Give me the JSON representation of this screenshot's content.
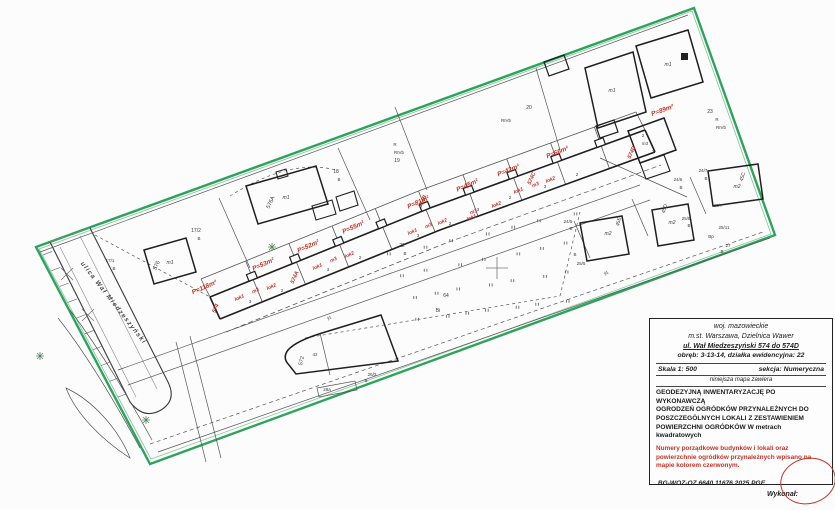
{
  "colors": {
    "boundary_green": "#2ea35b",
    "annotation_red": "#c23326",
    "line_black": "#3a3a3a"
  },
  "title_block": {
    "region1": "woj. mazowieckie",
    "region2": "m.st. Warszawa, Dzielnica Wawer",
    "address": "ul. Wał Miedzeszyński 574 do 574D",
    "plot": "obręb: 3-13-14, działka ewidencyjna: 22",
    "scale_label": "Skala 1: 500",
    "section_label": "sekcja: Numeryczna",
    "contains_note": "niniejsza mapa zawiera",
    "subject_lines": [
      "GEODEZYJNĄ  INWENTARYZACJĘ PO WYKONAWCZĄ",
      "OGRODZEŃ OGRÓDKÓW PRZYNALEŻNYCH DO",
      "POSZCZEGÓLNYCH LOKALI Z ZESTAWIENIEM",
      "POWIERZCHNI  OGRÓDKÓW W metrach kwadratowych"
    ],
    "red_note_lines": [
      "Numery porządkowe budynków i lokali oraz",
      "powierzchnie ogródków przynależnych wpisano  na",
      "mapie kolorem czerwonym."
    ],
    "doc_number": ".BG-WOZ-OZ.6640.11676.2025.PGE",
    "author_label": "Wykonał:"
  },
  "map": {
    "labels": [
      {
        "t": "ulica Wał Miedzeszyński",
        "x": 112,
        "y": 304,
        "r": 52,
        "s": 6.5,
        "c": "street",
        "n": "street-name-label"
      },
      {
        "t": "P=118m²",
        "x": 205,
        "y": 289,
        "r": -24,
        "s": 6.5,
        "c": "red",
        "n": "garden-area-label"
      },
      {
        "t": "P=53m²",
        "x": 264,
        "y": 266,
        "r": -24,
        "s": 6.5,
        "c": "red",
        "n": "garden-area-label"
      },
      {
        "t": "P=52m²",
        "x": 309,
        "y": 248,
        "r": -24,
        "s": 6.5,
        "c": "red",
        "n": "garden-area-label"
      },
      {
        "t": "P=55m²",
        "x": 354,
        "y": 229,
        "r": -24,
        "s": 6.5,
        "c": "red",
        "n": "garden-area-label"
      },
      {
        "t": "P=81m²",
        "x": 419,
        "y": 204,
        "r": -24,
        "s": 6.5,
        "c": "red",
        "n": "garden-area-label"
      },
      {
        "t": "P=45m²",
        "x": 468,
        "y": 187,
        "r": -24,
        "s": 6.5,
        "c": "red",
        "n": "garden-area-label"
      },
      {
        "t": "P=42m²",
        "x": 509,
        "y": 172,
        "r": -22,
        "s": 6.5,
        "c": "red",
        "n": "garden-area-label"
      },
      {
        "t": "P=66m²",
        "x": 558,
        "y": 154,
        "r": -22,
        "s": 6.5,
        "c": "red",
        "n": "garden-area-label"
      },
      {
        "t": "P=89m²",
        "x": 663,
        "y": 112,
        "r": -20,
        "s": 6.5,
        "c": "red",
        "n": "garden-area-label"
      },
      {
        "t": "lok1",
        "x": 240,
        "y": 299,
        "r": -24,
        "s": 5,
        "c": "red",
        "n": "unit-label"
      },
      {
        "t": "lok2",
        "x": 272,
        "y": 288,
        "r": -24,
        "s": 5,
        "c": "red",
        "n": "unit-label"
      },
      {
        "t": "lok1",
        "x": 318,
        "y": 268,
        "r": -24,
        "s": 5,
        "c": "red",
        "n": "unit-label"
      },
      {
        "t": "lok2",
        "x": 350,
        "y": 256,
        "r": -24,
        "s": 5,
        "c": "red",
        "n": "unit-label"
      },
      {
        "t": "lok1",
        "x": 413,
        "y": 233,
        "r": -24,
        "s": 5,
        "c": "red",
        "n": "unit-label"
      },
      {
        "t": "lok2",
        "x": 443,
        "y": 223,
        "r": -24,
        "s": 5,
        "c": "red",
        "n": "unit-label"
      },
      {
        "t": "lok1",
        "x": 472,
        "y": 219,
        "r": -22,
        "s": 5,
        "c": "red",
        "n": "unit-label"
      },
      {
        "t": "lok2",
        "x": 497,
        "y": 206,
        "r": -22,
        "s": 5,
        "c": "red",
        "n": "unit-label"
      },
      {
        "t": "lok1",
        "x": 519,
        "y": 192,
        "r": -22,
        "s": 5,
        "c": "red",
        "n": "unit-label"
      },
      {
        "t": "lok2",
        "x": 551,
        "y": 181,
        "r": -22,
        "s": 5,
        "c": "red",
        "n": "unit-label"
      },
      {
        "t": "m3",
        "x": 256,
        "y": 292,
        "r": -24,
        "s": 5,
        "c": "red",
        "n": "unit-label"
      },
      {
        "t": "m3",
        "x": 334,
        "y": 261,
        "r": -24,
        "s": 5,
        "c": "red",
        "n": "unit-label"
      },
      {
        "t": "m3",
        "x": 429,
        "y": 227,
        "r": -24,
        "s": 5,
        "c": "red",
        "n": "unit-label"
      },
      {
        "t": "m3",
        "x": 474,
        "y": 213,
        "r": -22,
        "s": 5,
        "c": "red",
        "n": "unit-label"
      },
      {
        "t": "m3",
        "x": 536,
        "y": 186,
        "r": -22,
        "s": 5,
        "c": "red",
        "n": "unit-label"
      },
      {
        "t": "574",
        "x": 217,
        "y": 309,
        "r": -66,
        "s": 5.5,
        "c": "red",
        "n": "building-number-label"
      },
      {
        "t": "574A",
        "x": 296,
        "y": 278,
        "r": -66,
        "s": 5.5,
        "c": "red",
        "n": "building-number-label"
      },
      {
        "t": "574B",
        "x": 424,
        "y": 202,
        "r": -66,
        "s": 5.5,
        "c": "red",
        "n": "building-number-label"
      },
      {
        "t": "574C",
        "x": 533,
        "y": 179,
        "r": -66,
        "s": 5.5,
        "c": "red",
        "n": "building-number-label"
      },
      {
        "t": "574D",
        "x": 633,
        "y": 153,
        "r": -66,
        "s": 5.5,
        "c": "red",
        "n": "building-number-label"
      },
      {
        "t": "17/1",
        "x": 110,
        "y": 262,
        "s": 4.5,
        "c": "blk",
        "n": "parcel-label"
      },
      {
        "t": "B",
        "x": 114,
        "y": 270,
        "s": 4.5,
        "c": "blk",
        "n": "landuse-label"
      },
      {
        "t": "17/2",
        "x": 196,
        "y": 232,
        "s": 5,
        "c": "blk",
        "n": "parcel-label"
      },
      {
        "t": "B",
        "x": 199,
        "y": 240,
        "s": 4.5,
        "c": "blk",
        "n": "landuse-label"
      },
      {
        "t": "18",
        "x": 336,
        "y": 173,
        "s": 5,
        "c": "blk",
        "n": "parcel-label"
      },
      {
        "t": "B",
        "x": 339,
        "y": 181,
        "s": 4.5,
        "c": "blk",
        "n": "landuse-label"
      },
      {
        "t": "R",
        "x": 395,
        "y": 146,
        "s": 4.5,
        "c": "blk",
        "n": "landuse-label"
      },
      {
        "t": "RIVb",
        "x": 399,
        "y": 154,
        "s": 4.5,
        "c": "blk",
        "n": "landuse-label"
      },
      {
        "t": "19",
        "x": 397,
        "y": 162,
        "s": 5,
        "c": "blk",
        "n": "parcel-label"
      },
      {
        "t": "20",
        "x": 529,
        "y": 109,
        "s": 5,
        "c": "blk",
        "n": "parcel-label"
      },
      {
        "t": "RIVb",
        "x": 506,
        "y": 122,
        "s": 4.5,
        "c": "blk",
        "n": "landuse-label"
      },
      {
        "t": "23",
        "x": 710,
        "y": 113,
        "s": 5,
        "c": "blk",
        "n": "parcel-label"
      },
      {
        "t": "R",
        "x": 717,
        "y": 121,
        "s": 4.5,
        "c": "blk",
        "n": "landuse-label"
      },
      {
        "t": "RIVb",
        "x": 721,
        "y": 129,
        "s": 4.5,
        "c": "blk",
        "n": "landuse-label"
      },
      {
        "t": "22",
        "x": 402,
        "y": 247,
        "s": 5,
        "c": "blk",
        "n": "parcel-label"
      },
      {
        "t": "B",
        "x": 405,
        "y": 255,
        "s": 4.5,
        "c": "blk",
        "n": "landuse-label"
      },
      {
        "t": "64",
        "x": 446,
        "y": 297,
        "s": 5,
        "c": "blk",
        "n": "parcel-label"
      },
      {
        "t": "Bi",
        "x": 438,
        "y": 312,
        "s": 5,
        "c": "blk",
        "n": "landuse-label"
      },
      {
        "t": "24/5",
        "x": 568,
        "y": 223,
        "s": 4.5,
        "c": "blk",
        "n": "parcel-label"
      },
      {
        "t": "B",
        "x": 571,
        "y": 230,
        "s": 4.5,
        "c": "blk",
        "n": "landuse-label"
      },
      {
        "t": "B",
        "x": 575,
        "y": 256,
        "s": 4.5,
        "c": "blk",
        "n": "landuse-label"
      },
      {
        "t": "25/5",
        "x": 581,
        "y": 265,
        "s": 4.5,
        "c": "blk",
        "n": "parcel-label"
      },
      {
        "t": "24/6",
        "x": 678,
        "y": 181,
        "s": 4.5,
        "c": "blk",
        "n": "parcel-label"
      },
      {
        "t": "B",
        "x": 681,
        "y": 189,
        "s": 4.5,
        "c": "blk",
        "n": "landuse-label"
      },
      {
        "t": "24/7",
        "x": 703,
        "y": 172,
        "s": 4.5,
        "c": "blk",
        "n": "parcel-label"
      },
      {
        "t": "B",
        "x": 706,
        "y": 180,
        "s": 4.5,
        "c": "blk",
        "n": "landuse-label"
      },
      {
        "t": "25/9",
        "x": 686,
        "y": 220,
        "s": 4.5,
        "c": "blk",
        "n": "parcel-label"
      },
      {
        "t": "B",
        "x": 689,
        "y": 227,
        "s": 4.5,
        "c": "blk",
        "n": "landuse-label"
      },
      {
        "t": "25/7",
        "x": 718,
        "y": 207,
        "s": 4.5,
        "c": "blk",
        "n": "parcel-label"
      },
      {
        "t": "25/11",
        "x": 724,
        "y": 229,
        "s": 4.5,
        "c": "blk",
        "n": "parcel-label"
      },
      {
        "t": "Bp",
        "x": 711,
        "y": 238,
        "s": 4.5,
        "c": "blk",
        "n": "landuse-label"
      },
      {
        "t": "27",
        "x": 728,
        "y": 247,
        "s": 4.5,
        "c": "blk",
        "n": "parcel-label"
      },
      {
        "t": "B",
        "x": 722,
        "y": 253,
        "s": 4.5,
        "c": "blk",
        "n": "landuse-label"
      },
      {
        "t": "26/3",
        "x": 372,
        "y": 376,
        "s": 4.5,
        "c": "blk",
        "n": "parcel-label"
      },
      {
        "t": "B",
        "x": 366,
        "y": 382,
        "s": 4.5,
        "c": "blk",
        "n": "landuse-label"
      },
      {
        "t": "28a",
        "x": 327,
        "y": 391,
        "s": 4.5,
        "c": "blk",
        "n": "parcel-label"
      },
      {
        "t": "jd.",
        "x": 330,
        "y": 319,
        "r": -15,
        "s": 4.5,
        "c": "blk",
        "n": "path-label"
      },
      {
        "t": "jd.",
        "x": 607,
        "y": 274,
        "r": -20,
        "s": 4.5,
        "c": "blk",
        "n": "path-label"
      },
      {
        "t": "m1",
        "x": 170,
        "y": 264,
        "s": 5,
        "c": "bld",
        "n": "building-type-label"
      },
      {
        "t": "m1",
        "x": 286,
        "y": 199,
        "s": 5,
        "c": "bld",
        "n": "building-type-label"
      },
      {
        "t": "m1",
        "x": 612,
        "y": 92,
        "s": 5,
        "c": "bld",
        "n": "building-type-label"
      },
      {
        "t": "m1",
        "x": 668,
        "y": 66,
        "s": 5,
        "c": "bld",
        "n": "building-type-label"
      },
      {
        "t": "m2",
        "x": 608,
        "y": 235,
        "s": 5,
        "c": "bld",
        "n": "building-type-label"
      },
      {
        "t": "m2",
        "x": 672,
        "y": 224,
        "s": 5,
        "c": "bld",
        "n": "building-type-label"
      },
      {
        "t": "m2",
        "x": 737,
        "y": 188,
        "s": 5,
        "c": "bld",
        "n": "building-type-label"
      },
      {
        "t": "m3",
        "x": 645,
        "y": 145,
        "s": 4.5,
        "c": "bld",
        "n": "building-type-label"
      },
      {
        "t": "2",
        "x": 643,
        "y": 137,
        "s": 4.5,
        "c": "blk",
        "n": "unit-count-label"
      },
      {
        "t": "3",
        "x": 653,
        "y": 153,
        "s": 4.5,
        "c": "blk",
        "n": "unit-count-label"
      },
      {
        "t": "576",
        "x": 158,
        "y": 266,
        "r": -66,
        "s": 5.5,
        "c": "blk",
        "n": "building-number-label"
      },
      {
        "t": "576A",
        "x": 272,
        "y": 203,
        "r": -66,
        "s": 5.5,
        "c": "blk",
        "n": "building-number-label"
      },
      {
        "t": "572",
        "x": 303,
        "y": 361,
        "r": -78,
        "s": 5.5,
        "c": "blk",
        "n": "building-number-label"
      },
      {
        "t": "42",
        "x": 315,
        "y": 356,
        "s": 4.5,
        "c": "blk",
        "n": "building-number-label"
      },
      {
        "t": "45C",
        "x": 744,
        "y": 177,
        "r": -75,
        "s": 5,
        "c": "blk",
        "n": "building-number-label"
      },
      {
        "t": "45D",
        "x": 666,
        "y": 209,
        "r": -75,
        "s": 5,
        "c": "blk",
        "n": "building-number-label"
      },
      {
        "t": "45E",
        "x": 620,
        "y": 222,
        "r": -75,
        "s": 5,
        "c": "blk",
        "n": "building-number-label"
      },
      {
        "t": "3",
        "x": 250,
        "y": 303,
        "s": 4.5,
        "c": "blk",
        "n": "unit-count-label"
      },
      {
        "t": "2",
        "x": 282,
        "y": 292,
        "s": 4.5,
        "c": "blk",
        "n": "unit-count-label"
      },
      {
        "t": "3",
        "x": 328,
        "y": 271,
        "s": 4.5,
        "c": "blk",
        "n": "unit-count-label"
      },
      {
        "t": "2",
        "x": 360,
        "y": 259,
        "s": 4.5,
        "c": "blk",
        "n": "unit-count-label"
      },
      {
        "t": "3",
        "x": 418,
        "y": 237,
        "s": 4.5,
        "c": "blk",
        "n": "unit-count-label"
      },
      {
        "t": "2",
        "x": 450,
        "y": 225,
        "s": 4.5,
        "c": "blk",
        "n": "unit-count-label"
      },
      {
        "t": "3",
        "x": 478,
        "y": 211,
        "s": 4.5,
        "c": "blk",
        "n": "unit-count-label"
      },
      {
        "t": "2",
        "x": 510,
        "y": 199,
        "s": 4.5,
        "c": "blk",
        "n": "unit-count-label"
      },
      {
        "t": "3",
        "x": 545,
        "y": 188,
        "s": 4.5,
        "c": "blk",
        "n": "unit-count-label"
      },
      {
        "t": "2",
        "x": 577,
        "y": 176,
        "s": 4.5,
        "c": "blk",
        "n": "unit-count-label"
      }
    ]
  }
}
